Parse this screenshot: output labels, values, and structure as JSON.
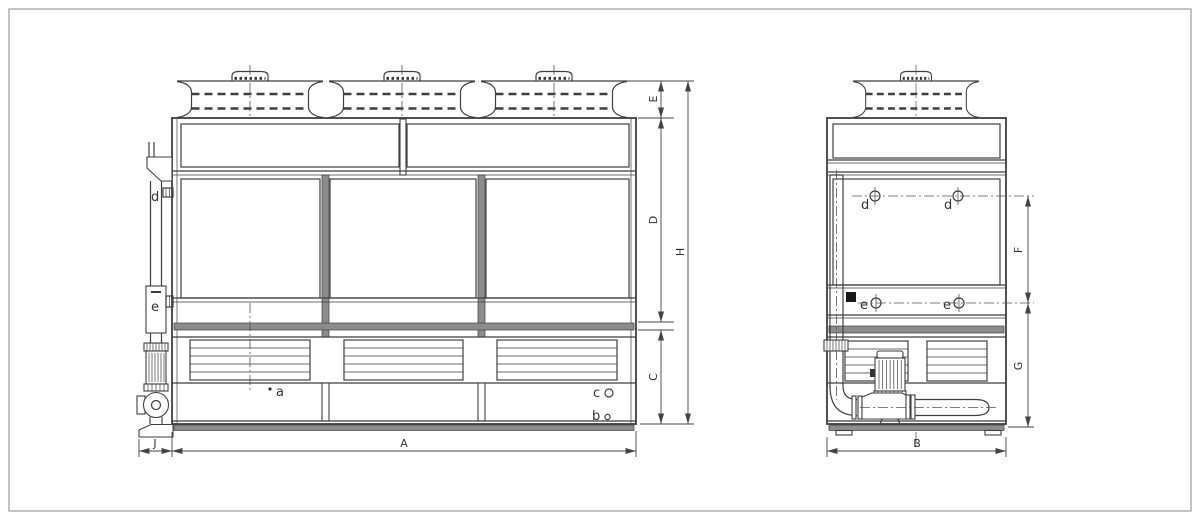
{
  "page": {
    "background": "#ffffff",
    "border_color": "#9b9b9b"
  },
  "drawing": {
    "line_color": "#3f3f3f",
    "band_fill": "#8c8c8c",
    "front_view": {
      "connections": {
        "d": "d",
        "e": "e",
        "a": "a",
        "c": "c",
        "b": "b"
      },
      "dimensions": {
        "E": "E",
        "D": "D",
        "C": "C",
        "H": "H",
        "A": "A",
        "J": "J"
      }
    },
    "side_view": {
      "connections": {
        "d_left": "d",
        "d_right": "d",
        "e_left": "e",
        "e_right": "e"
      },
      "dimensions": {
        "F": "F",
        "G": "G",
        "B": "B"
      }
    }
  }
}
